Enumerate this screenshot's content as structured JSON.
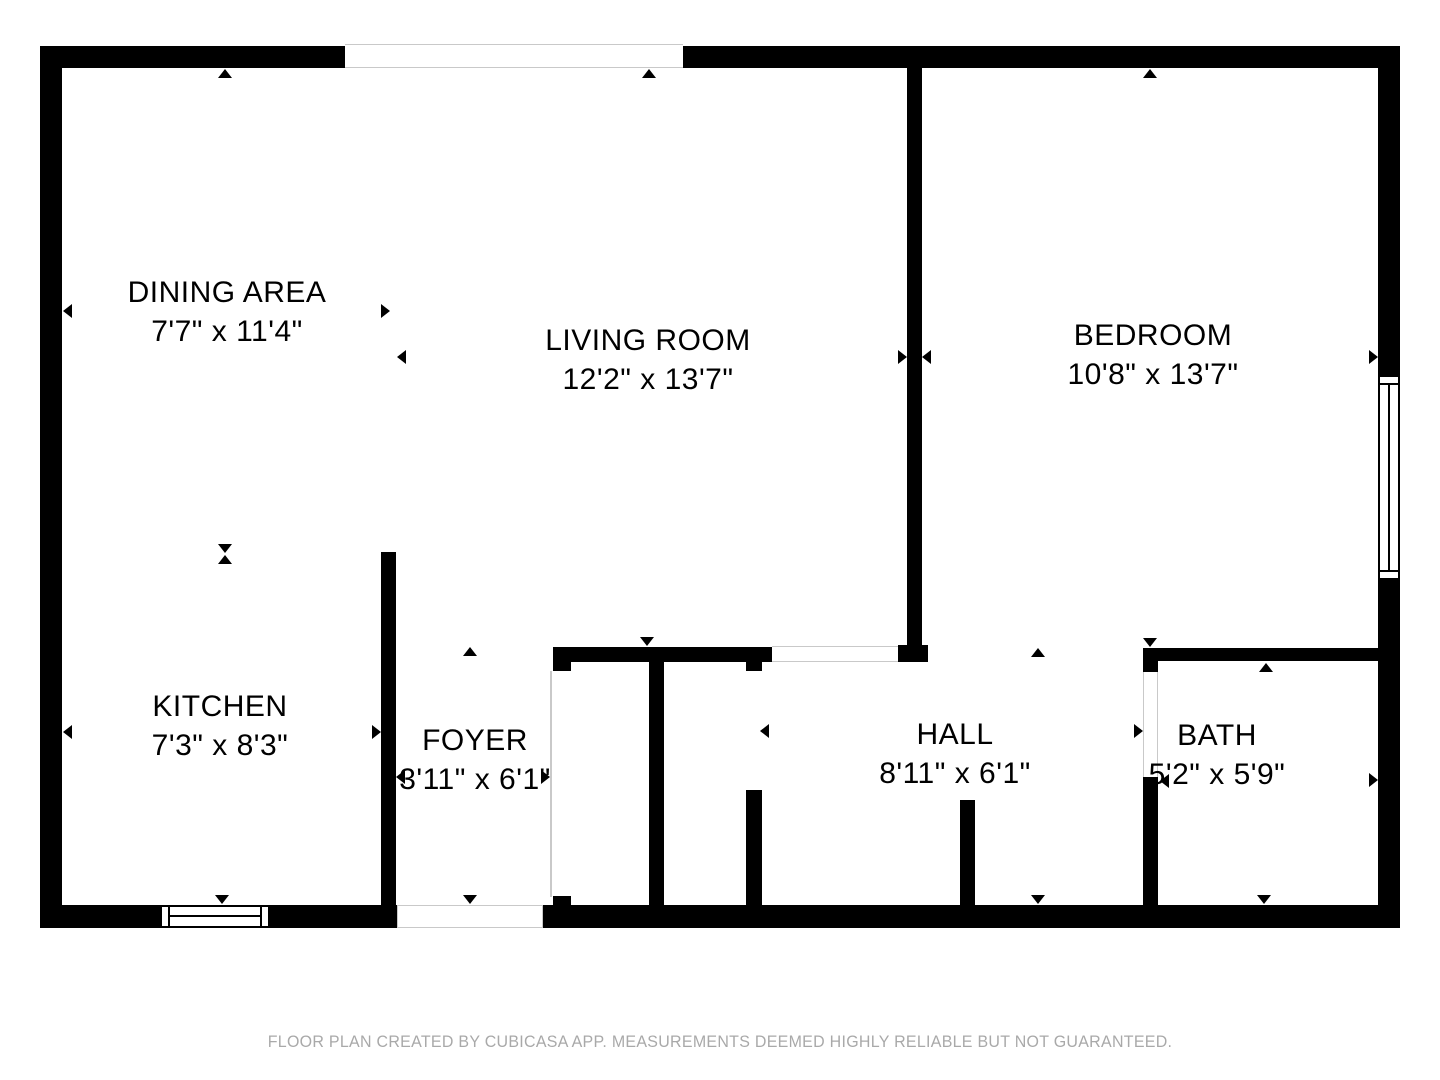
{
  "rooms": [
    {
      "id": "dining-area",
      "name": "DINING AREA",
      "dims": "7'7\" x 11'4\""
    },
    {
      "id": "living-room",
      "name": "LIVING ROOM",
      "dims": "12'2\" x 13'7\""
    },
    {
      "id": "bedroom",
      "name": "BEDROOM",
      "dims": "10'8\" x 13'7\""
    },
    {
      "id": "kitchen",
      "name": "KITCHEN",
      "dims": "7'3\" x 8'3\""
    },
    {
      "id": "foyer",
      "name": "FOYER",
      "dims": "3'11\" x 6'1\""
    },
    {
      "id": "hall",
      "name": "HALL",
      "dims": "8'11\" x 6'1\""
    },
    {
      "id": "bath",
      "name": "BATH",
      "dims": "5'2\" x 5'9\""
    }
  ],
  "footer": {
    "disclaimer": "FLOOR PLAN CREATED BY CUBICASA APP. MEASUREMENTS DEEMED HIGHLY RELIABLE BUT NOT GUARANTEED."
  },
  "colors": {
    "wall": "#000000",
    "opening_outline": "#c9c9c9",
    "footer_text": "#a9a9a9",
    "background": "#ffffff"
  },
  "markers": [
    {
      "room": "dining-area",
      "dir": "left",
      "x": 63,
      "y": 311
    },
    {
      "room": "dining-area",
      "dir": "right",
      "x": 390,
      "y": 311
    },
    {
      "room": "dining-area",
      "dir": "up",
      "x": 225,
      "y": 69
    },
    {
      "room": "dining-area",
      "dir": "down",
      "x": 225,
      "y": 553
    },
    {
      "room": "living-room",
      "dir": "left",
      "x": 397,
      "y": 357
    },
    {
      "room": "living-room",
      "dir": "right",
      "x": 907,
      "y": 357
    },
    {
      "room": "living-room",
      "dir": "up",
      "x": 649,
      "y": 69
    },
    {
      "room": "living-room",
      "dir": "down",
      "x": 647,
      "y": 646
    },
    {
      "room": "bedroom",
      "dir": "left",
      "x": 922,
      "y": 357
    },
    {
      "room": "bedroom",
      "dir": "right",
      "x": 1378,
      "y": 357
    },
    {
      "room": "bedroom",
      "dir": "up",
      "x": 1150,
      "y": 69
    },
    {
      "room": "bedroom",
      "dir": "down",
      "x": 1150,
      "y": 647
    },
    {
      "room": "kitchen",
      "dir": "left",
      "x": 63,
      "y": 732
    },
    {
      "room": "kitchen",
      "dir": "right",
      "x": 381,
      "y": 732
    },
    {
      "room": "kitchen",
      "dir": "up",
      "x": 225,
      "y": 555
    },
    {
      "room": "kitchen",
      "dir": "down",
      "x": 222,
      "y": 904
    },
    {
      "room": "foyer",
      "dir": "left",
      "x": 396,
      "y": 777
    },
    {
      "room": "foyer",
      "dir": "right",
      "x": 550,
      "y": 777
    },
    {
      "room": "foyer",
      "dir": "up",
      "x": 470,
      "y": 647
    },
    {
      "room": "foyer",
      "dir": "down",
      "x": 470,
      "y": 904
    },
    {
      "room": "hall",
      "dir": "left",
      "x": 760,
      "y": 731
    },
    {
      "room": "hall",
      "dir": "right",
      "x": 1143,
      "y": 731
    },
    {
      "room": "hall",
      "dir": "up",
      "x": 1038,
      "y": 648
    },
    {
      "room": "hall",
      "dir": "down",
      "x": 1038,
      "y": 904
    },
    {
      "room": "bath",
      "dir": "left",
      "x": 1160,
      "y": 781
    },
    {
      "room": "bath",
      "dir": "right",
      "x": 1378,
      "y": 780
    },
    {
      "room": "bath",
      "dir": "up",
      "x": 1266,
      "y": 663
    },
    {
      "room": "bath",
      "dir": "down",
      "x": 1264,
      "y": 904
    }
  ]
}
